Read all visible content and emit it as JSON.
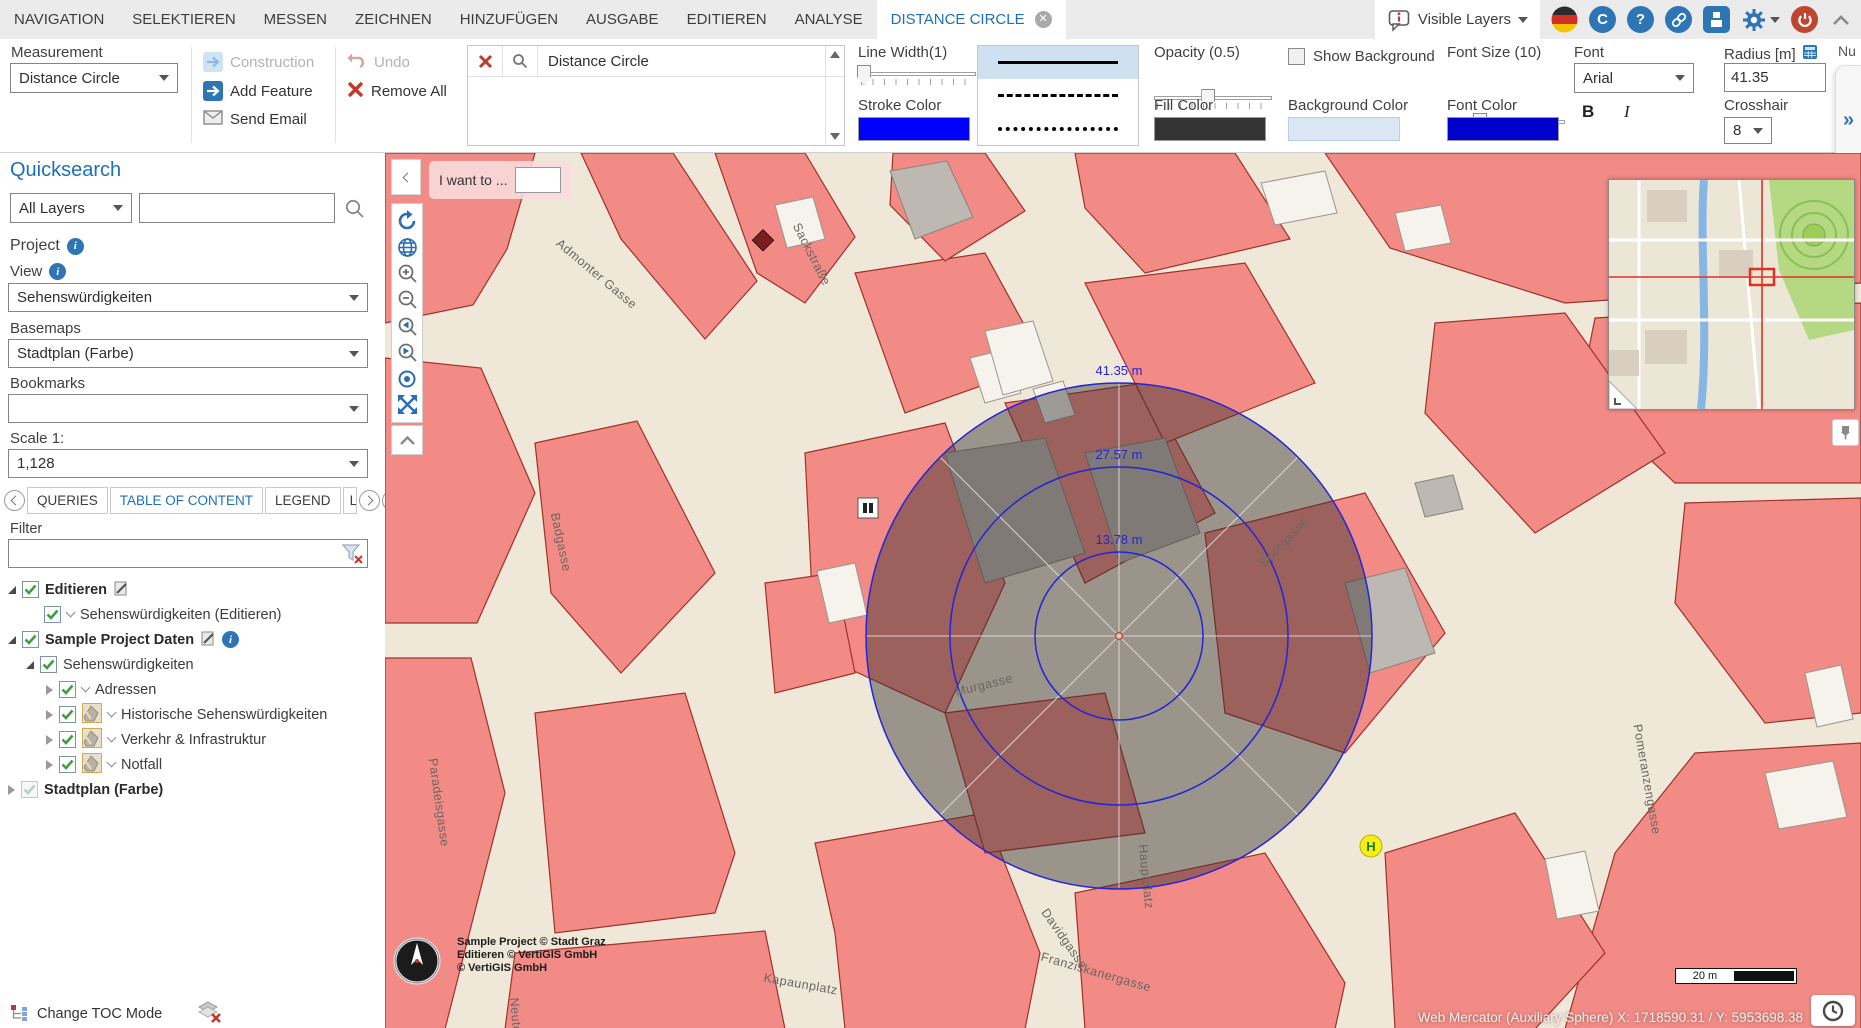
{
  "menu": {
    "tabs": [
      "NAVIGATION",
      "SELEKTIEREN",
      "MESSEN",
      "ZEICHNEN",
      "HINZUFÜGEN",
      "AUSGABE",
      "EDITIEREN",
      "ANALYSE"
    ],
    "active_tab": "DISTANCE CIRCLE",
    "visible_layers": "Visible Layers"
  },
  "ribbon": {
    "measurement_label": "Measurement",
    "measurement_value": "Distance Circle",
    "construction": "Construction",
    "add_feature": "Add Feature",
    "send_email": "Send Email",
    "undo": "Undo",
    "remove_all": "Remove All",
    "shape_name": "Distance Circle",
    "line_width_label": "Line Width(1)",
    "stroke_color_label": "Stroke Color",
    "stroke_color": "#0000ff",
    "opacity_label": "Opacity (0.5)",
    "fill_color_label": "Fill Color",
    "fill_color": "#333333",
    "show_background_label": "Show Background",
    "background_color_label": "Background Color",
    "background_color": "#dbe7f5",
    "font_size_label": "Font Size (10)",
    "font_color_label": "Font Color",
    "font_color": "#0000cc",
    "font_label": "Font",
    "font_value": "Arial",
    "bold_label": "B",
    "italic_label": "I",
    "radius_label": "Radius [m]",
    "radius_value": "41.35",
    "crosshair_label": "Crosshair",
    "crosshair_value": "8",
    "expand_more": "»",
    "clipped_label": "Nu"
  },
  "sidebar": {
    "quicksearch_title": "Quicksearch",
    "layers_select": "All Layers",
    "project_label": "Project",
    "view_label": "View",
    "view_value": "Sehenswürdigkeiten",
    "basemaps_label": "Basemaps",
    "basemaps_value": "Stadtplan (Farbe)",
    "bookmarks_label": "Bookmarks",
    "scale_label": "Scale 1:",
    "scale_value": "1,128",
    "tabs": [
      "QUERIES",
      "TABLE OF CONTENT",
      "LEGEND",
      "L"
    ],
    "filter_label": "Filter",
    "toc": [
      {
        "label": "Editieren"
      },
      {
        "label": "Sehenswürdigkeiten (Editieren)"
      },
      {
        "label": "Sample Project Daten"
      },
      {
        "label": "Sehenswürdigkeiten"
      },
      {
        "label": "Adressen"
      },
      {
        "label": "Historische Sehenswürdigkeiten"
      },
      {
        "label": "Verkehr & Infrastruktur"
      },
      {
        "label": "Notfall"
      },
      {
        "label": "Stadtplan (Farbe)"
      }
    ],
    "change_toc_mode": "Change TOC Mode"
  },
  "map": {
    "i_want_to": "I want to ...",
    "circle_labels": [
      "41.35 m",
      "27.57 m",
      "13.78 m"
    ],
    "streets": {
      "sackstrasse": "Sackstraße",
      "admonter": "Admonter Gasse",
      "badgasse": "Badgasse",
      "murgasse": "Murgasse",
      "sporgasse": "Sporgasse",
      "hauptplatz": "Hauptplatz",
      "paradeisgasse": "Paradeisgasse",
      "davidgasse": "Davidgasse",
      "kapaunplatz": "Kapaunplatz",
      "franziskanergasse": "Franziskanergasse",
      "pomeranzengasse": "Pomeranzengasse",
      "neutorgasse": "Neutorgasse"
    },
    "marker_h": "H",
    "copyright": [
      "Sample Project © Stadt Graz",
      "Editieren © VertiGIS GmbH",
      "© VertiGIS GmbH"
    ],
    "scalebar_label": "20 m",
    "status_text": "Web Mercator (Auxiliary Sphere) X: 1718590.31 / Y: 5953698.38"
  }
}
